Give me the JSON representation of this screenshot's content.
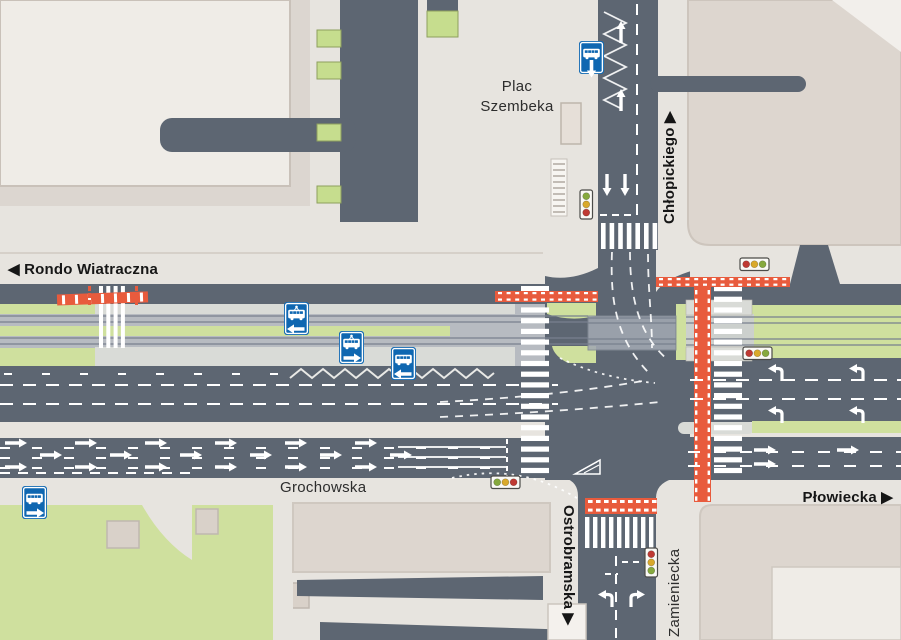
{
  "labels": {
    "rondo_wiatraczna": "◀ Rondo Wiatraczna",
    "plac_line1": "Plac",
    "plac_line2": "Szembeka",
    "chlopickiego": "Chłopickiego ▶",
    "grochowska": "Grochowska",
    "plowiecka": "Płowiecka ▶",
    "ostrobramska": "Ostrobramska ▶",
    "zamieniecka": "Zamieniecka"
  },
  "colors": {
    "road": "#5d6672",
    "sidewalk": "#e7e4df",
    "sidewalk_dark": "#dcd6d0",
    "building_light": "#efece7",
    "building_mid": "#ddd6cf",
    "building_small": "#d9d1c9",
    "green": "#cfe09e",
    "green_bright": "#c6dd8e",
    "track_bed": "#b7bbc1",
    "platform": "#d9dbd7",
    "crossing_box": "#a2a9b2",
    "orange": "#e85b3d",
    "stop_blue": "#0f67b1",
    "light_red": "#bf3a33",
    "light_yellow": "#d9a92b",
    "light_green": "#86a93e"
  },
  "stops": [
    {
      "type": "bus",
      "arrow": "down",
      "x": 579,
      "y": 41
    },
    {
      "type": "tram",
      "arrow": "left",
      "x": 284,
      "y": 302
    },
    {
      "type": "tram",
      "arrow": "right",
      "x": 339,
      "y": 331
    },
    {
      "type": "bus",
      "arrow": "left",
      "x": 391,
      "y": 347
    },
    {
      "type": "bus",
      "arrow": "right",
      "x": 22,
      "y": 486
    }
  ],
  "traffic_lights": [
    {
      "orientation": "vertical",
      "colors": [
        "green",
        "yellow",
        "red"
      ],
      "x": 580,
      "y": 190
    },
    {
      "orientation": "horizontal",
      "colors": [
        "red",
        "yellow",
        "green"
      ],
      "x": 740,
      "y": 258
    },
    {
      "orientation": "horizontal",
      "colors": [
        "red",
        "yellow",
        "green"
      ],
      "x": 743,
      "y": 347
    },
    {
      "orientation": "horizontal",
      "colors": [
        "green",
        "yellow",
        "red"
      ],
      "x": 491,
      "y": 476
    },
    {
      "orientation": "vertical",
      "colors": [
        "red",
        "yellow",
        "green"
      ],
      "x": 645,
      "y": 548
    }
  ]
}
